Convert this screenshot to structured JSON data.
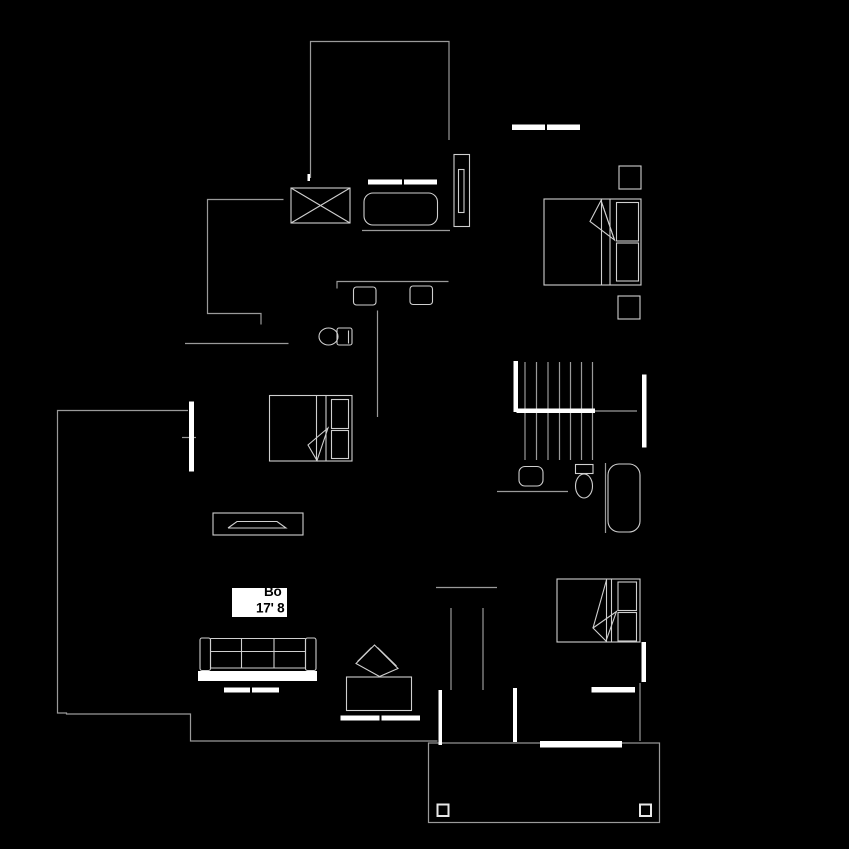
{
  "colors": {
    "background": "#000000",
    "outline": "#9a9a9a",
    "furniture": "#cfcfcf",
    "wall": "#ffffff",
    "post": "#e8e8e8",
    "label_box": "#ffffff",
    "label_text": "#000000"
  },
  "room_label": {
    "line1": "Bo",
    "line2": "17' 8"
  }
}
